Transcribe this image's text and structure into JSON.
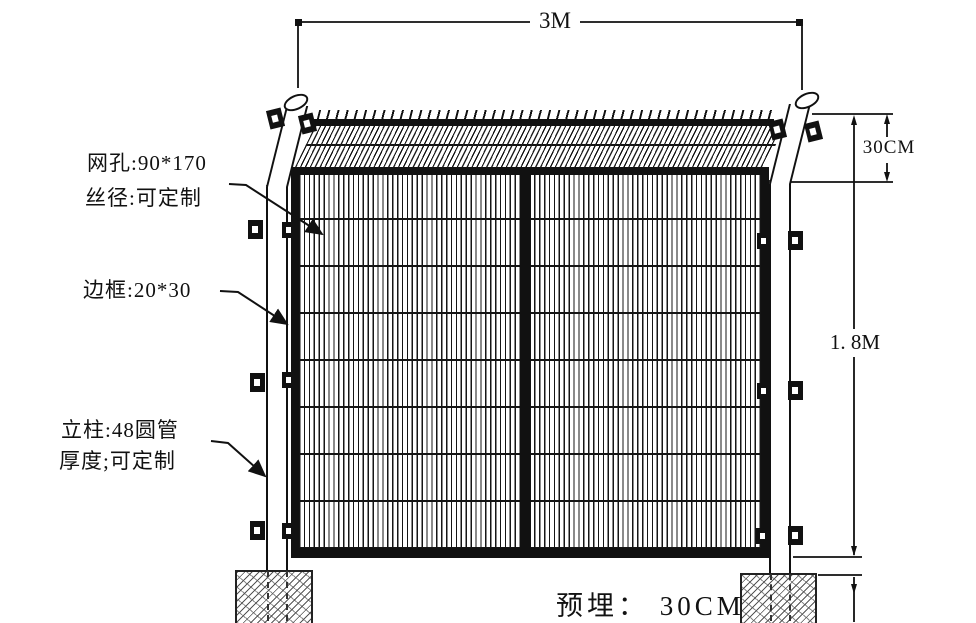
{
  "drawing": {
    "title_hint": "framework-fence-technical-diagram",
    "dimensions": {
      "width_top": "3M",
      "bend_height_right": "30CM",
      "panel_height_right": "1. 8M",
      "embed_depth_bottom": "预埋： 30CM"
    },
    "labels": {
      "mesh_line1": "网孔:90*170",
      "mesh_line2": "丝径:可定制",
      "frame": "边框:20*30",
      "post_line1": "立柱:48圆管",
      "post_line2": "厚度;可定制"
    },
    "colors": {
      "ink": "#111111",
      "background": "#ffffff",
      "hatch": "#555555"
    }
  }
}
